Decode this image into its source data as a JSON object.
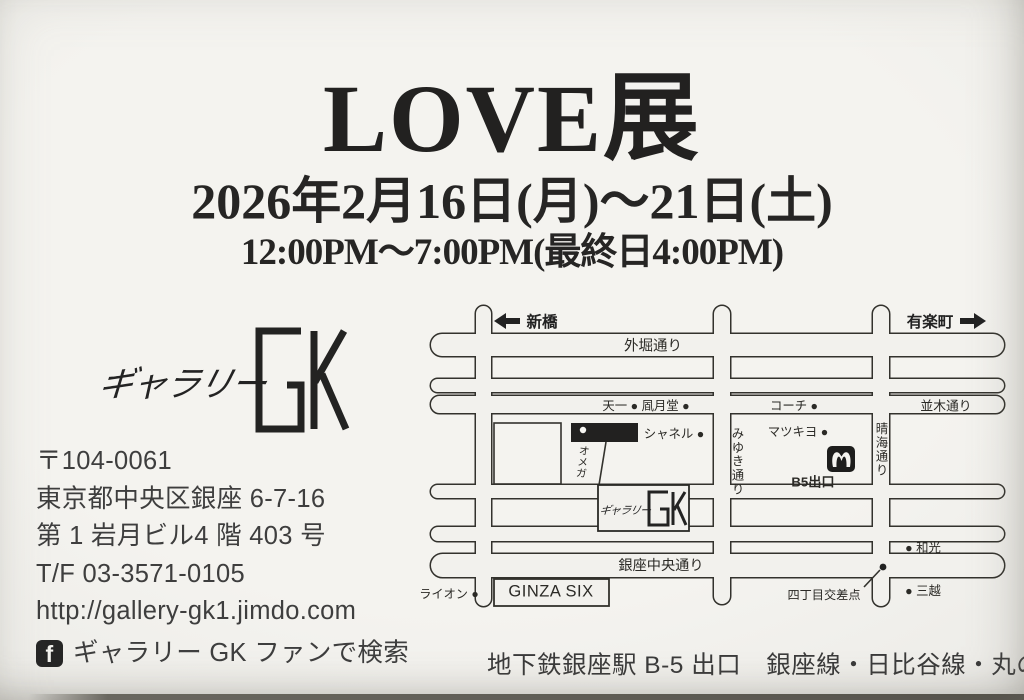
{
  "colors": {
    "paper": "#f2f1ed",
    "ink": "#222120",
    "text_gray": "#3e3e3e",
    "map_ink": "#2b2a26"
  },
  "header": {
    "title": "LOVE展",
    "date": "2026年2月16日(月)〜21日(土)",
    "time": "12:00PM〜7:00PM(最終日4:00PM)"
  },
  "gallery": {
    "logo_script": "ギャラリー",
    "logo_initials": "GK",
    "postal_code": "〒104-0061",
    "address_line1": "東京都中央区銀座 6-7-16",
    "address_line2": "第 1 岩月ビル4 階 403 号",
    "tel_fax": "T/F 03-3571-0105",
    "website": "http://gallery-gk1.jimdo.com",
    "facebook_icon_letter": "f",
    "facebook_search": "ギャラリー GK ファンで検索"
  },
  "map": {
    "direction_left": "新橋",
    "direction_right": "有楽町",
    "street_sotobori": "外堀通り",
    "row_tenichi_fugetsudo": "天一 ● 凮月堂 ●",
    "row_coach": "コーチ ●",
    "street_namiki": "並木通り",
    "poi_chanel": "シャネル ●",
    "poi_matsukiyo": "マツキヨ ●",
    "street_miyuki": "みゆき通り",
    "street_harumi": "晴海通り",
    "exit_b5": "B5出口",
    "poi_omega": "オメガ",
    "gallery_box_script": "ギャラリー",
    "poi_wako": "● 和光",
    "street_chuo": "銀座中央通り",
    "poi_lion": "ライオン ●",
    "poi_ginza_six": "GINZA SIX",
    "poi_yonchome": "四丁目交差点",
    "poi_mitsukoshi": "● 三越",
    "caption": "地下鉄銀座駅 B-5 出口　銀座線・日比谷線・丸の内線"
  }
}
